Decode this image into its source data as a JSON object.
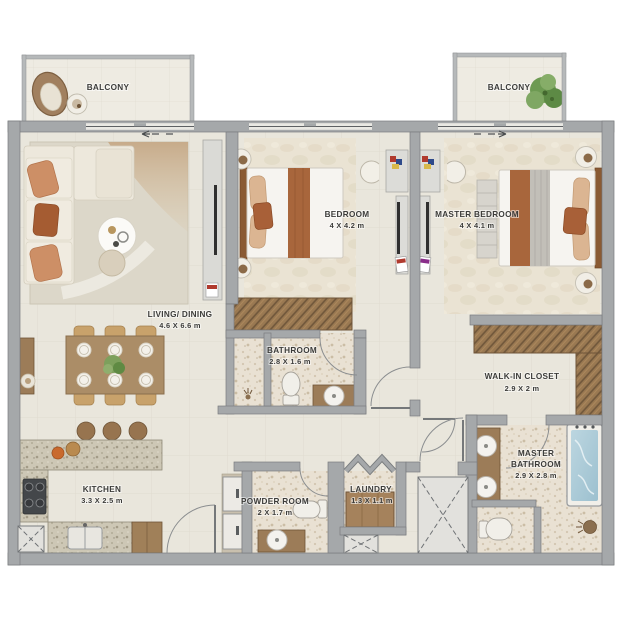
{
  "plan": {
    "type": "apartment-floor-plan",
    "colors": {
      "wall": "#a5a8aa",
      "wall_dark": "#7a7d7f",
      "floor": "#e9e6dc",
      "terrazzo": "#e9e1d3",
      "balcony_floor": "#eeebe2",
      "wood": "#9c7c58",
      "wardrobe": "#9a7952",
      "granite": "#cdc7b4",
      "rust_fabric": "#a8663c",
      "tan_fabric": "#dbb592",
      "sofa_cream": "#ede8dc",
      "tub_water": "#aecbd8",
      "plant_green": "#6d9a52",
      "label_text": "#3c3c3a"
    }
  },
  "rooms": {
    "balcony_left": {
      "name": "BALCONY"
    },
    "balcony_right": {
      "name": "BALCONY"
    },
    "living_dining": {
      "name": "LIVING/ DINING",
      "dims": "4.6 X 6.6 m"
    },
    "bedroom": {
      "name": "BEDROOM",
      "dims": "4 X 4.2 m"
    },
    "master_bedroom": {
      "name": "MASTER BEDROOM",
      "dims": "4 X 4.1 m"
    },
    "bathroom": {
      "name": "BATHROOM",
      "dims": "2.8 X 1.6 m"
    },
    "walk_in_closet": {
      "name": "WALK-IN CLOSET",
      "dims": "2.9 X 2 m"
    },
    "master_bathroom": {
      "line1": "MASTER",
      "line2": "BATHROOM",
      "dims": "2.9 X 2.8 m"
    },
    "kitchen": {
      "name": "KITCHEN",
      "dims": "3.3 X 2.5 m"
    },
    "powder_room": {
      "name": "POWDER ROOM",
      "dims": "2 X 1.7 m"
    },
    "laundry": {
      "name": "LAUNDRY",
      "dims": "1.3 X 1.1 m"
    }
  }
}
